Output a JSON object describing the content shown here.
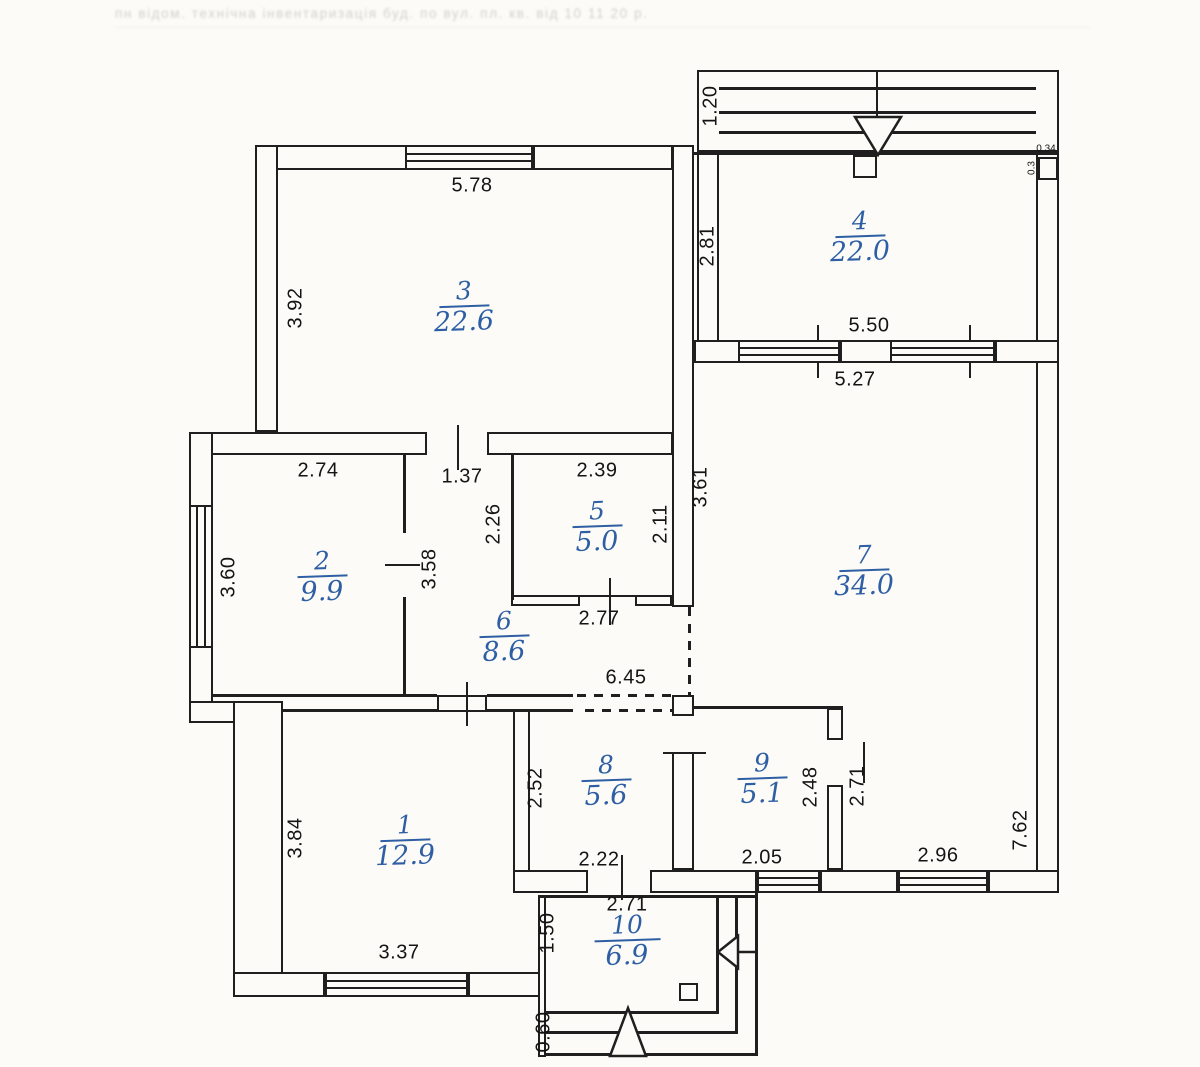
{
  "canvas": {
    "width": 1200,
    "height": 1067,
    "paper": "#fcfbf7",
    "ink": "#1f1f1f",
    "accent": "#2e5fa4"
  },
  "faint_header_text": "пн відом. технічна інвентаризація буд. по вул. пл. кв. від 10 11 20 р.",
  "rooms": [
    {
      "number": "1",
      "area": "12.9",
      "x": 405,
      "y": 842
    },
    {
      "number": "2",
      "area": "9.9",
      "x": 322,
      "y": 578
    },
    {
      "number": "3",
      "area": "22.6",
      "x": 464,
      "y": 308
    },
    {
      "number": "4",
      "area": "22.0",
      "x": 860,
      "y": 238
    },
    {
      "number": "5",
      "area": "5.0",
      "x": 597,
      "y": 528
    },
    {
      "number": "6",
      "area": "8.6",
      "x": 504,
      "y": 638
    },
    {
      "number": "7",
      "area": "34.0",
      "x": 864,
      "y": 572
    },
    {
      "number": "8",
      "area": "5.6",
      "x": 606,
      "y": 782
    },
    {
      "number": "9",
      "area": "5.1",
      "x": 762,
      "y": 780
    },
    {
      "number": "10",
      "area": "6.9",
      "x": 627,
      "y": 942
    }
  ],
  "dimensions": [
    {
      "text": "5.78",
      "x": 472,
      "y": 186
    },
    {
      "text": "3.92",
      "x": 296,
      "y": 308,
      "rotated": true
    },
    {
      "text": "1.20",
      "x": 711,
      "y": 106,
      "rotated": true
    },
    {
      "text": "2.81",
      "x": 708,
      "y": 246,
      "rotated": true
    },
    {
      "text": "0.34",
      "x": 1046,
      "y": 149,
      "small": true
    },
    {
      "text": "0.3",
      "x": 1032,
      "y": 168,
      "rotated": true,
      "small": true
    },
    {
      "text": "5.50",
      "x": 869,
      "y": 326
    },
    {
      "text": "5.27",
      "x": 855,
      "y": 380
    },
    {
      "text": "2.74",
      "x": 318,
      "y": 471
    },
    {
      "text": "1.37",
      "x": 462,
      "y": 477
    },
    {
      "text": "2.39",
      "x": 597,
      "y": 471
    },
    {
      "text": "3.61",
      "x": 701,
      "y": 487,
      "rotated": true
    },
    {
      "text": "2.26",
      "x": 494,
      "y": 524,
      "rotated": true
    },
    {
      "text": "2.11",
      "x": 661,
      "y": 524,
      "rotated": true
    },
    {
      "text": "3.60",
      "x": 229,
      "y": 577,
      "rotated": true
    },
    {
      "text": "3.58",
      "x": 430,
      "y": 569,
      "rotated": true
    },
    {
      "text": "2.77",
      "x": 599,
      "y": 619
    },
    {
      "text": "6.45",
      "x": 626,
      "y": 678
    },
    {
      "text": "7.62",
      "x": 1021,
      "y": 830,
      "rotated": true
    },
    {
      "text": "2.52",
      "x": 536,
      "y": 788,
      "rotated": true
    },
    {
      "text": "2.48",
      "x": 811,
      "y": 787,
      "rotated": true
    },
    {
      "text": "2.71",
      "x": 858,
      "y": 786,
      "rotated": true
    },
    {
      "text": "3.84",
      "x": 296,
      "y": 838,
      "rotated": true
    },
    {
      "text": "2.22",
      "x": 599,
      "y": 860
    },
    {
      "text": "2.05",
      "x": 762,
      "y": 858
    },
    {
      "text": "2.96",
      "x": 938,
      "y": 856
    },
    {
      "text": "3.37",
      "x": 399,
      "y": 953
    },
    {
      "text": "2.71",
      "x": 627,
      "y": 905
    },
    {
      "text": "1.50",
      "x": 548,
      "y": 933,
      "rotated": true
    },
    {
      "text": "0.60",
      "x": 544,
      "y": 1032,
      "rotated": true
    }
  ]
}
